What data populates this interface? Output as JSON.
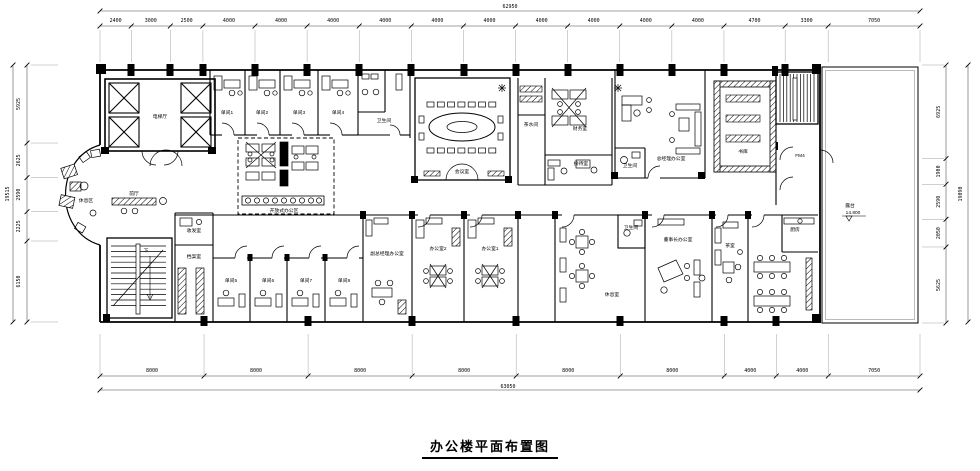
{
  "title": "办公楼平面布置图",
  "dim_chains": {
    "top": {
      "total": "62950",
      "segments": [
        2400,
        3000,
        2500,
        4000,
        4000,
        4000,
        4000,
        4000,
        4000,
        4000,
        4000,
        4000,
        4000,
        4700,
        3300,
        7050
      ]
    },
    "bottom": {
      "total": "63050",
      "segments": [
        8000,
        8000,
        8000,
        8000,
        8000,
        8000,
        4000,
        4000,
        7050
      ]
    },
    "left": {
      "total": "19515",
      "segments": [
        5925,
        2625,
        2590,
        2225,
        6150
      ]
    },
    "right": {
      "total": "19090",
      "segments": [
        6925,
        1900,
        2590,
        2050,
        5625
      ]
    }
  },
  "plan": {
    "labels": [
      {
        "name": "elevator-hall",
        "text": "电梯厅",
        "x": 160,
        "y": 118
      },
      {
        "name": "single-office-1",
        "text": "单间1",
        "x": 227,
        "y": 114
      },
      {
        "name": "single-office-2",
        "text": "单间2",
        "x": 262,
        "y": 114
      },
      {
        "name": "single-office-3",
        "text": "单间3",
        "x": 299,
        "y": 114
      },
      {
        "name": "single-office-4",
        "text": "单间4",
        "x": 338,
        "y": 114
      },
      {
        "name": "washroom-top",
        "text": "卫生间",
        "x": 384,
        "y": 122
      },
      {
        "name": "conference-room",
        "text": "会议室",
        "x": 462,
        "y": 173
      },
      {
        "name": "pantry",
        "text": "茶水间",
        "x": 531,
        "y": 126
      },
      {
        "name": "finance-room",
        "text": "财务室",
        "x": 580,
        "y": 130
      },
      {
        "name": "reception-room",
        "text": "接待室",
        "x": 581,
        "y": 165
      },
      {
        "name": "gm-office",
        "text": "总经理办公室",
        "x": 671,
        "y": 160
      },
      {
        "name": "gm-washroom",
        "text": "卫生间",
        "x": 630,
        "y": 167
      },
      {
        "name": "library",
        "text": "书库",
        "x": 743,
        "y": 153
      },
      {
        "name": "stair-door-tag",
        "text": "FM4",
        "x": 800,
        "y": 157
      },
      {
        "name": "terrace",
        "text": "露台",
        "x": 850,
        "y": 207
      },
      {
        "name": "terrace-level",
        "text": "14.800",
        "x": 853,
        "y": 214
      },
      {
        "name": "front-hall",
        "text": "前厅",
        "x": 134,
        "y": 195
      },
      {
        "name": "lounge-area",
        "text": "休息区",
        "x": 86,
        "y": 202
      },
      {
        "name": "open-office",
        "text": "开放式办公区",
        "x": 284,
        "y": 212
      },
      {
        "name": "mail-room",
        "text": "收发室",
        "x": 194,
        "y": 232
      },
      {
        "name": "archive-room",
        "text": "档案室",
        "x": 194,
        "y": 258
      },
      {
        "name": "stairs-down",
        "text": "下",
        "x": 146,
        "y": 252
      },
      {
        "name": "single-office-5",
        "text": "单间5",
        "x": 231,
        "y": 282
      },
      {
        "name": "single-office-6",
        "text": "单间6",
        "x": 268,
        "y": 282
      },
      {
        "name": "single-office-7",
        "text": "单间7",
        "x": 306,
        "y": 282
      },
      {
        "name": "single-office-8",
        "text": "单间8",
        "x": 344,
        "y": 282
      },
      {
        "name": "deputy-gm-office",
        "text": "副总经理办公室",
        "x": 387,
        "y": 255
      },
      {
        "name": "office-2",
        "text": "办公室2",
        "x": 438,
        "y": 250
      },
      {
        "name": "office-1",
        "text": "办公室1",
        "x": 490,
        "y": 250
      },
      {
        "name": "rest-room",
        "text": "休息室",
        "x": 612,
        "y": 296
      },
      {
        "name": "washroom-bottom",
        "text": "卫生间",
        "x": 631,
        "y": 229
      },
      {
        "name": "chairman-office",
        "text": "董事长办公室",
        "x": 678,
        "y": 241
      },
      {
        "name": "tea-room",
        "text": "茶室",
        "x": 730,
        "y": 247
      },
      {
        "name": "kitchen",
        "text": "厨房",
        "x": 795,
        "y": 231
      }
    ]
  }
}
